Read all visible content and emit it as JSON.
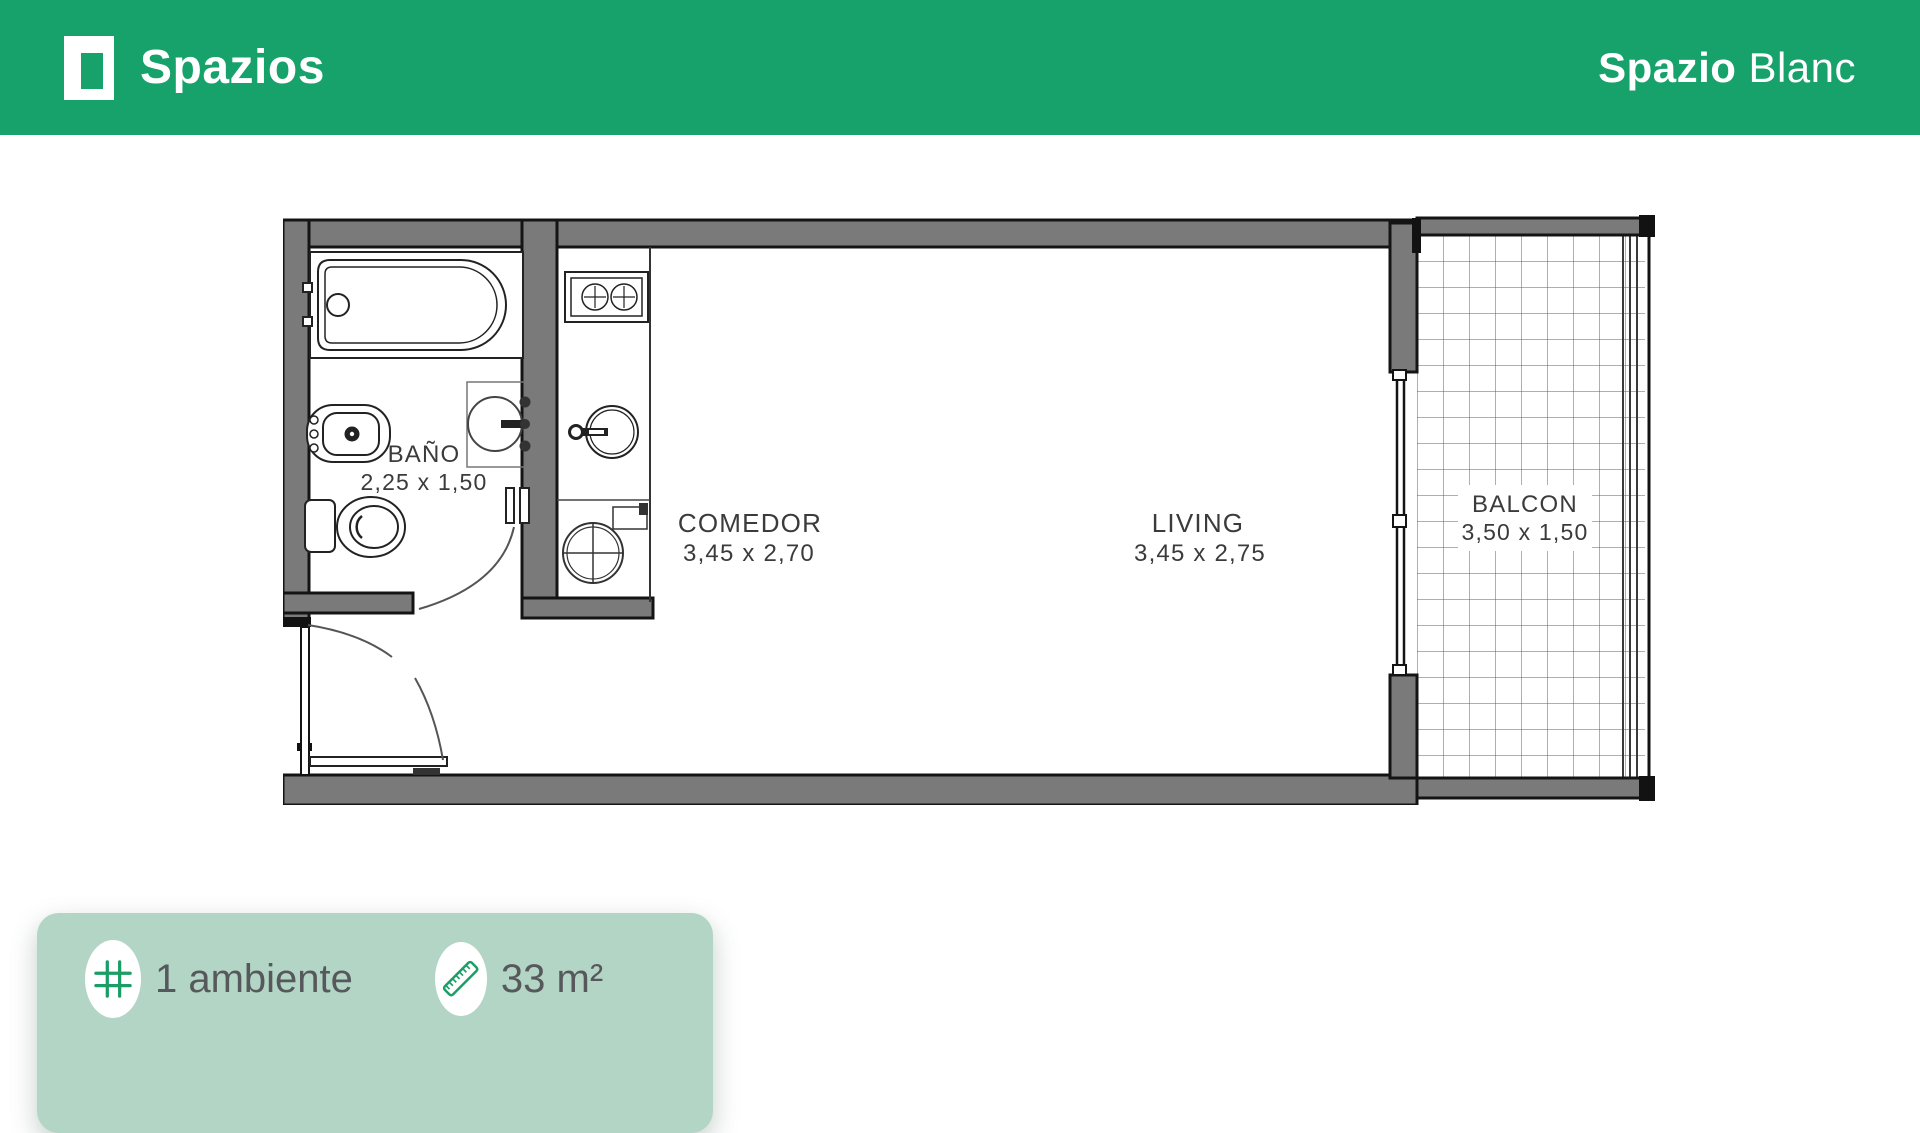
{
  "header": {
    "brand": "Spazios",
    "project_bold": "Spazio",
    "project_regular": "Blanc"
  },
  "floorplan": {
    "rooms": {
      "bano": {
        "label": "BAÑO",
        "dims": "2,25 x 1,50"
      },
      "comedor": {
        "label": "COMEDOR",
        "dims": "3,45 x 2,70"
      },
      "living": {
        "label": "LIVING",
        "dims": "3,45 x 2,75"
      },
      "balcon": {
        "label": "BALCON",
        "dims": "3,50 x 1,50"
      }
    },
    "fixtures": [
      "bathtub",
      "bathroom-sink",
      "bidet",
      "toilet",
      "stove",
      "kitchen-sink",
      "washing-machine",
      "sliding-door",
      "entry-door",
      "balcony-railing",
      "tile-grid"
    ]
  },
  "summary": {
    "rooms_count": "1 ambiente",
    "area": "33 m²",
    "icons": [
      "grid-icon",
      "ruler-icon"
    ]
  },
  "colors": {
    "header_green": "#16A26A",
    "card_green": "#B2D5C5",
    "icon_green": "#1B9E66",
    "wall_gray": "#7A7A7A"
  }
}
